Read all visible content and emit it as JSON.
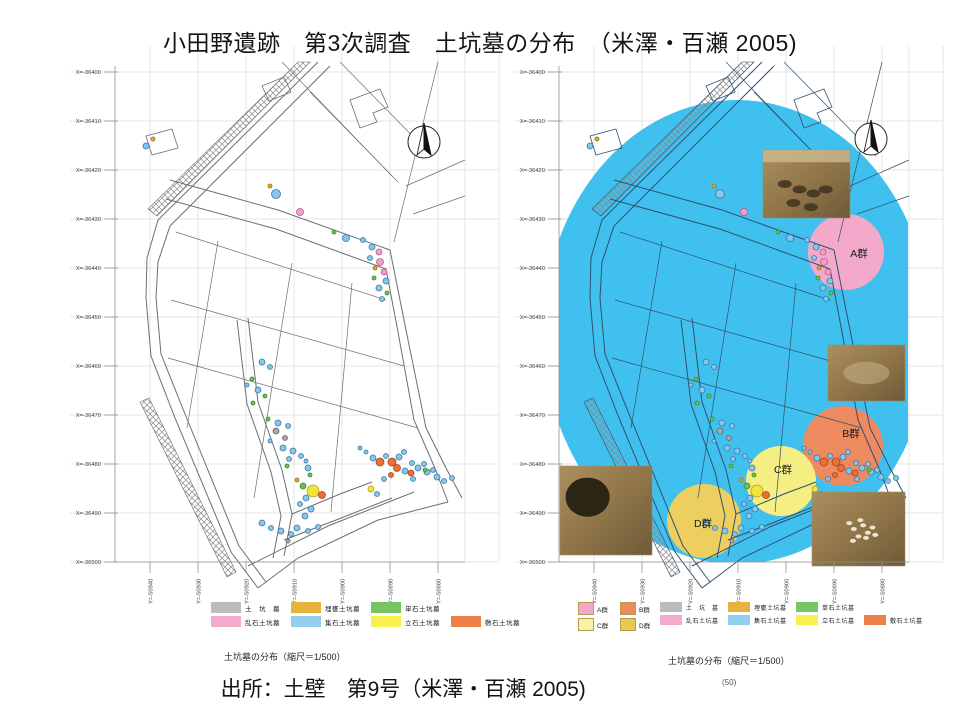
{
  "slide": {
    "title": "小田野遺跡　第3次調査　土坑墓の分布　（米澤・百瀬 2005)",
    "source": "出所：土壁　第9号（米澤・百瀬 2005)"
  },
  "axes": {
    "x_ticks": [
      "X=-36400",
      "X=-36410",
      "X=-36420",
      "X=-36430",
      "X=-36440",
      "X=-36450",
      "X=-36460",
      "X=-36470",
      "X=-36480",
      "X=-36490",
      "X=-36500"
    ],
    "y_ticks": [
      "Y=-50940",
      "Y=-50930",
      "Y=-50920",
      "Y=-50910",
      "Y=-50900",
      "Y=-50890",
      "Y=-50880"
    ]
  },
  "legend": {
    "items": [
      {
        "label": "土　坑　墓",
        "color": "#bcbcbc"
      },
      {
        "label": "埋甕土坑墓",
        "color": "#e6b33c"
      },
      {
        "label": "単石土坑墓",
        "color": "#77c565"
      },
      {
        "label": "乱石土坑墓",
        "color": "#f3abcb"
      },
      {
        "label": "集石土坑墓",
        "color": "#92cfee"
      },
      {
        "label": "立石土坑墓",
        "color": "#f7f14f"
      },
      {
        "label": "敷石土坑墓",
        "color": "#ec8046"
      }
    ]
  },
  "left_map": {
    "caption": "土坑墓の分布（縮尺＝1/500）"
  },
  "right_map": {
    "caption": "土坑墓の分布（縮尺＝1/500）",
    "page_note": "(50)",
    "overlay_color": "#3fc0ee",
    "groups": [
      {
        "label": "A群",
        "color": "#f3a9c9",
        "cx": 846,
        "cy": 252,
        "r": 38,
        "lx": 859,
        "ly": 257
      },
      {
        "label": "B群",
        "color": "#ee8a60",
        "cx": 843,
        "cy": 446,
        "r": 40,
        "lx": 851,
        "ly": 437
      },
      {
        "label": "C群",
        "color": "#f5ee82",
        "cx": 781,
        "cy": 481,
        "r": 35,
        "lx": 783,
        "ly": 473
      },
      {
        "label": "D群",
        "color": "#eccf5e",
        "cx": 704,
        "cy": 521,
        "r": 37,
        "lx": 703,
        "ly": 527
      }
    ],
    "group_legend": [
      {
        "label": "A群",
        "color": "#f3a9c9"
      },
      {
        "label": "B群",
        "color": "#ee8a60"
      },
      {
        "label": "C群",
        "color": "#f8f0a8"
      },
      {
        "label": "D群",
        "color": "#e8c84e"
      }
    ],
    "photos": [
      {
        "name": "excavation-photo-top",
        "x": 763,
        "y": 150,
        "w": 87,
        "h": 68,
        "kind": "pits"
      },
      {
        "name": "excavation-photo-middle",
        "x": 828,
        "y": 345,
        "w": 77,
        "h": 56,
        "kind": "plain"
      },
      {
        "name": "excavation-photo-bottom-left",
        "x": 560,
        "y": 466,
        "w": 92,
        "h": 89,
        "kind": "dark"
      },
      {
        "name": "excavation-photo-bottom-right",
        "x": 812,
        "y": 492,
        "w": 93,
        "h": 74,
        "kind": "bones"
      }
    ]
  },
  "dot_colors": {
    "b": [
      "#85c6e9",
      "#3878a8"
    ],
    "p": [
      "#f0a0c4",
      "#b85890"
    ],
    "g": [
      "#6dbd58",
      "#3d8a2e"
    ],
    "o": [
      "#e97038",
      "#a84418"
    ],
    "y": [
      "#f2e43f",
      "#b0a010"
    ],
    "a": [
      "#d8a838",
      "#9a7618"
    ],
    "gr": [
      "#a8a8a8",
      "#666666"
    ]
  },
  "points": [
    [
      146,
      146,
      "b",
      3
    ],
    [
      153,
      139,
      "a",
      2
    ],
    [
      276,
      194,
      "b",
      4.5
    ],
    [
      270,
      186,
      "a",
      2
    ],
    [
      300,
      212,
      "p",
      3.5
    ],
    [
      334,
      232,
      "g",
      2
    ],
    [
      346,
      238,
      "b",
      3.5
    ],
    [
      363,
      240,
      "b",
      2.5
    ],
    [
      372,
      247,
      "b",
      3
    ],
    [
      379,
      252,
      "p",
      3
    ],
    [
      370,
      258,
      "b",
      2.5
    ],
    [
      380,
      262,
      "p",
      3.5
    ],
    [
      375,
      268,
      "a",
      2
    ],
    [
      384,
      272,
      "p",
      3
    ],
    [
      374,
      278,
      "g",
      2
    ],
    [
      386,
      281,
      "b",
      3
    ],
    [
      379,
      288,
      "b",
      3
    ],
    [
      387,
      293,
      "g",
      2
    ],
    [
      382,
      299,
      "b",
      2.5
    ],
    [
      262,
      362,
      "b",
      3
    ],
    [
      270,
      367,
      "b",
      2.5
    ],
    [
      252,
      379,
      "g",
      2
    ],
    [
      247,
      385,
      "b",
      2
    ],
    [
      258,
      390,
      "b",
      3
    ],
    [
      265,
      396,
      "g",
      2
    ],
    [
      253,
      403,
      "g",
      2
    ],
    [
      268,
      419,
      "g",
      2
    ],
    [
      278,
      423,
      "b",
      3
    ],
    [
      288,
      426,
      "b",
      2.5
    ],
    [
      276,
      431,
      "gr",
      3
    ],
    [
      285,
      438,
      "gr",
      2.5
    ],
    [
      270,
      441,
      "b",
      2
    ],
    [
      283,
      448,
      "b",
      3
    ],
    [
      293,
      451,
      "b",
      3
    ],
    [
      289,
      459,
      "b",
      2.5
    ],
    [
      287,
      466,
      "g",
      2
    ],
    [
      301,
      456,
      "b",
      2.5
    ],
    [
      306,
      461,
      "b",
      2
    ],
    [
      308,
      468,
      "b",
      3
    ],
    [
      310,
      475,
      "g",
      2
    ],
    [
      297,
      480,
      "a",
      2
    ],
    [
      303,
      486,
      "g",
      3
    ],
    [
      313,
      491,
      "y",
      6
    ],
    [
      322,
      495,
      "o",
      3.5
    ],
    [
      306,
      498,
      "b",
      3
    ],
    [
      300,
      504,
      "b",
      2.5
    ],
    [
      311,
      509,
      "b",
      3
    ],
    [
      305,
      516,
      "b",
      3
    ],
    [
      262,
      523,
      "b",
      3
    ],
    [
      271,
      528,
      "b",
      2.5
    ],
    [
      281,
      531,
      "b",
      3
    ],
    [
      291,
      534,
      "b",
      2.5
    ],
    [
      297,
      528,
      "b",
      3
    ],
    [
      308,
      531,
      "b",
      2.5
    ],
    [
      318,
      527,
      "b",
      2.5
    ],
    [
      288,
      541,
      "gr",
      2
    ],
    [
      366,
      452,
      "b",
      2
    ],
    [
      360,
      448,
      "b",
      2
    ],
    [
      373,
      458,
      "b",
      3
    ],
    [
      380,
      462,
      "o",
      4
    ],
    [
      386,
      456,
      "b",
      2.5
    ],
    [
      392,
      462,
      "o",
      4
    ],
    [
      399,
      457,
      "b",
      3
    ],
    [
      404,
      452,
      "b",
      2.5
    ],
    [
      397,
      468,
      "o",
      3.5
    ],
    [
      405,
      471,
      "b",
      3
    ],
    [
      412,
      463,
      "b",
      2.5
    ],
    [
      411,
      473,
      "o",
      3
    ],
    [
      418,
      468,
      "b",
      3
    ],
    [
      424,
      464,
      "b",
      2.5
    ],
    [
      427,
      472,
      "b",
      3
    ],
    [
      433,
      470,
      "b",
      2.5
    ],
    [
      437,
      477,
      "b",
      3
    ],
    [
      413,
      479,
      "b",
      2.5
    ],
    [
      391,
      475,
      "o",
      2.5
    ],
    [
      384,
      479,
      "b",
      2.5
    ],
    [
      425,
      470,
      "g",
      2
    ],
    [
      444,
      481,
      "b",
      2.5
    ],
    [
      452,
      478,
      "b",
      2.5
    ],
    [
      371,
      489,
      "y",
      3
    ],
    [
      377,
      494,
      "b",
      2.5
    ]
  ],
  "north_arrow": {
    "icon": "compass-north-arrow"
  }
}
